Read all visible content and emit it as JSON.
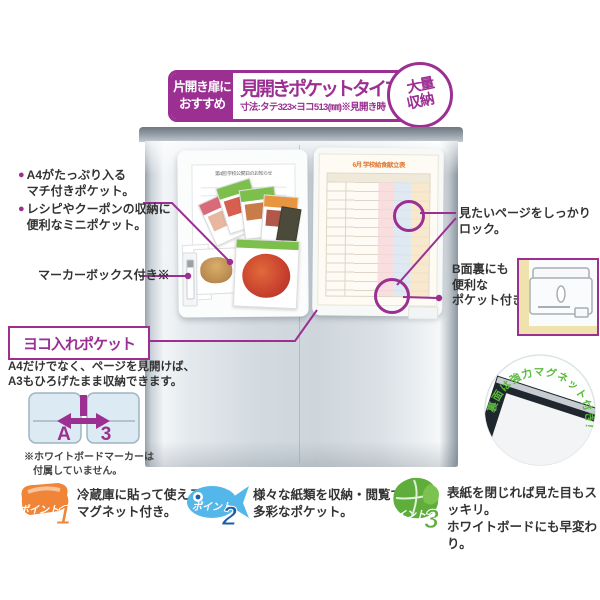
{
  "colors": {
    "accent": "#9B2F92",
    "point1": "#F08437",
    "point2": "#54B7E9",
    "point2_num": "#1A5EA8",
    "point3": "#5FAE3C",
    "magnet_green": "#59B93C"
  },
  "header": {
    "ribbon": [
      "片開き扉に",
      "おすすめ"
    ],
    "title": "見開きポケットタイプ",
    "dimensions": "寸法:タテ323×ヨコ513(㎜)※見開き時",
    "badge": [
      "大量",
      "収納"
    ]
  },
  "left_panel": {
    "bullet1": [
      "A4がたっぷり入る",
      "マチ付きポケット。"
    ],
    "bullet2": [
      "レシピやクーポンの収納に",
      "便利なミニポケット。"
    ],
    "marker_label": "マーカーボックス付き※"
  },
  "yoko": {
    "title": "ヨコ入れポケット",
    "desc": [
      "A4だけでなく、ページを見開けば、",
      "A3もひろげたまま収納できます。"
    ],
    "a3": [
      "A",
      "3"
    ],
    "note": [
      "※ホワイトボードマーカーは",
      "付属していません。"
    ]
  },
  "right_panel": {
    "lock_label": "見たいページをしっかりロック。",
    "bside": [
      "B面裏にも",
      "便利な",
      "ポケット付き。"
    ],
    "magnet_label": "裏面は強力マグネット付き!"
  },
  "product": {
    "notice_title": "第4回 学校公開日のお知らせ",
    "menu_title": "6月 学校給食献立表"
  },
  "points": [
    {
      "name": "ポイント",
      "num": "1",
      "lines": [
        "冷蔵庫に貼って使える",
        "マグネット付き。"
      ]
    },
    {
      "name": "ポイント",
      "num": "2",
      "lines": [
        "様々な紙類を収納・閲覧できる",
        "多彩なポケット。"
      ]
    },
    {
      "name": "ポイント",
      "num": "3",
      "lines": [
        "表紙を閉じれば見た目もスッキリ。",
        "ホワイトボードにも早変わり。"
      ]
    }
  ]
}
